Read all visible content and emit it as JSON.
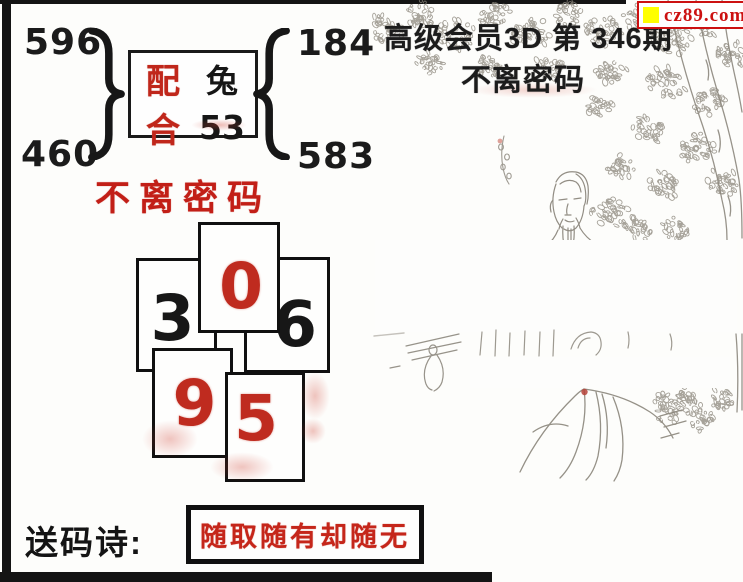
{
  "site_badge": {
    "text": "cz89.com"
  },
  "header": {
    "title": "高级会员3D 第 346期",
    "subtitle": "不离密码"
  },
  "pairing": {
    "left_top": "596",
    "left_bottom": "460",
    "label_top": "配",
    "label_bottom": "合",
    "zodiac": "兔",
    "number": "53",
    "right_top": "184",
    "right_bottom": "583"
  },
  "password_title": "不离密码",
  "cards": [
    {
      "digit": "3",
      "ink": "black"
    },
    {
      "digit": "6",
      "ink": "black"
    },
    {
      "digit": "0",
      "ink": "red"
    },
    {
      "digit": "9",
      "ink": "red"
    },
    {
      "digit": "5",
      "ink": "red"
    }
  ],
  "poem": {
    "label": "送码诗:",
    "text": "随取随有却随无"
  },
  "colors": {
    "accent_red": "#c1271d",
    "ink_black": "#161616",
    "badge_red": "#cc1111",
    "badge_yellow": "#ffff00",
    "sketch_gray": "#8d887e"
  }
}
